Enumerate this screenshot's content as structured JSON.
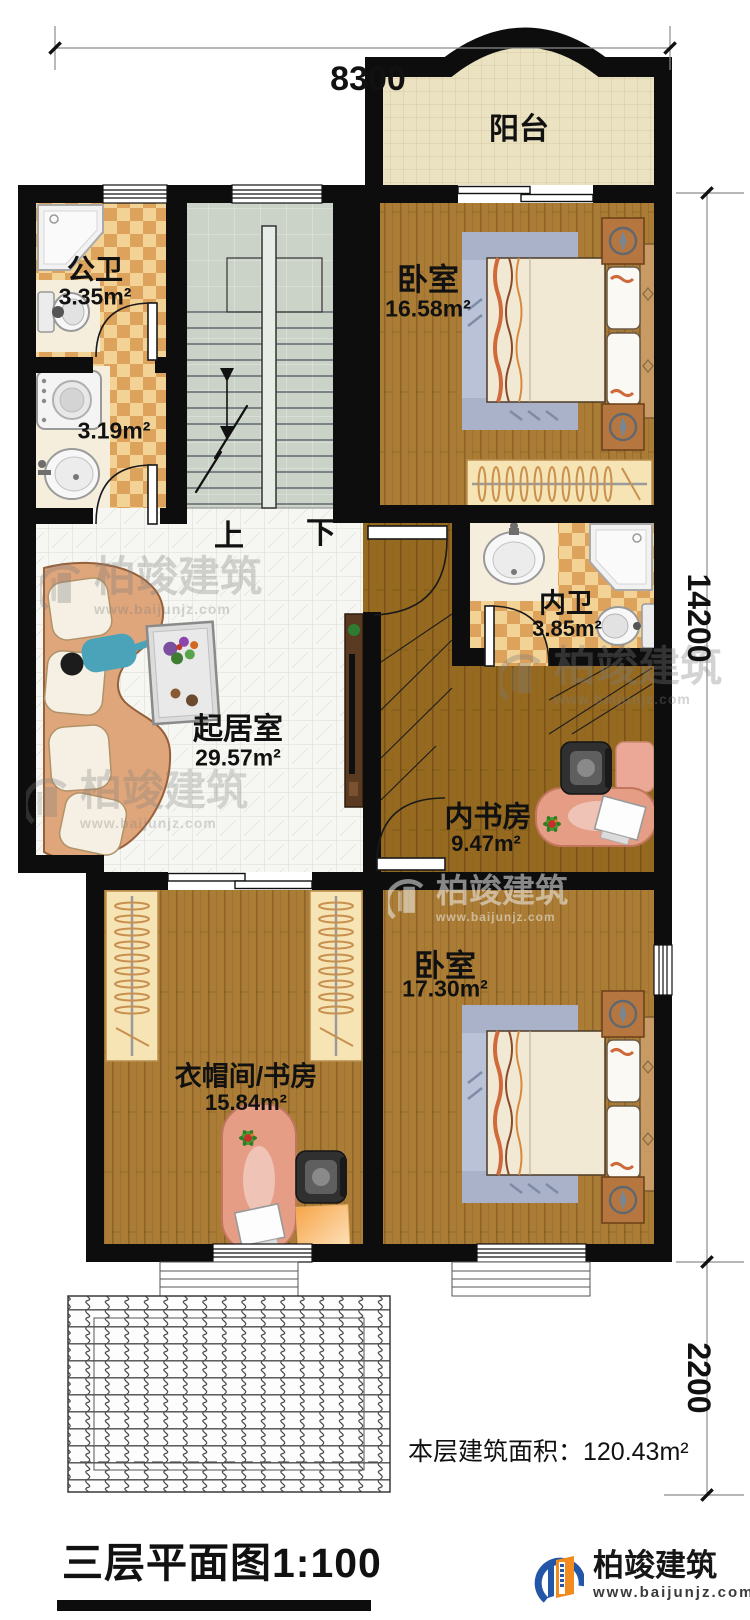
{
  "title_block": {
    "title": "三层平面图1:100",
    "total_area": "本层建筑面积：120.43m²"
  },
  "dimensions": {
    "top_width": "8300",
    "right_height": "14200",
    "porch_depth": "2200"
  },
  "rooms": {
    "balcony": {
      "name": "阳台"
    },
    "public_bath": {
      "name": "公卫",
      "area": "3.35m²"
    },
    "laundry": {
      "area": "3.19m²"
    },
    "bedroom_top": {
      "name": "卧室",
      "area": "16.58m²"
    },
    "inner_bath": {
      "name": "内卫",
      "area": "3.85m²"
    },
    "living": {
      "name": "起居室",
      "area": "29.57m²"
    },
    "inner_study": {
      "name": "内书房",
      "area": "9.47m²"
    },
    "cloakroom": {
      "name": "衣帽间/书房",
      "area": "15.84m²"
    },
    "bedroom_bottom": {
      "name": "卧室",
      "area": "17.30m²"
    }
  },
  "stairs": {
    "up": "上",
    "down": "下"
  },
  "brand": {
    "name": "柏竣建筑",
    "url": "www.baijunjz.com"
  },
  "watermark": {
    "name": "柏竣建筑",
    "url": "www.baijunjz.com"
  },
  "colors": {
    "wall": "#0d0d0d",
    "wood_light": "#aa7c35",
    "wood_dark": "#95691f",
    "checker_light": "#f2d295",
    "checker_dark": "#dda25c",
    "stair_tile": "#cbd3c8",
    "living_tile": "#f6f6f2",
    "balcony_tile": "#eae2c0",
    "brand_blue": "#2356a7",
    "brand_orange": "#f28a1e"
  }
}
